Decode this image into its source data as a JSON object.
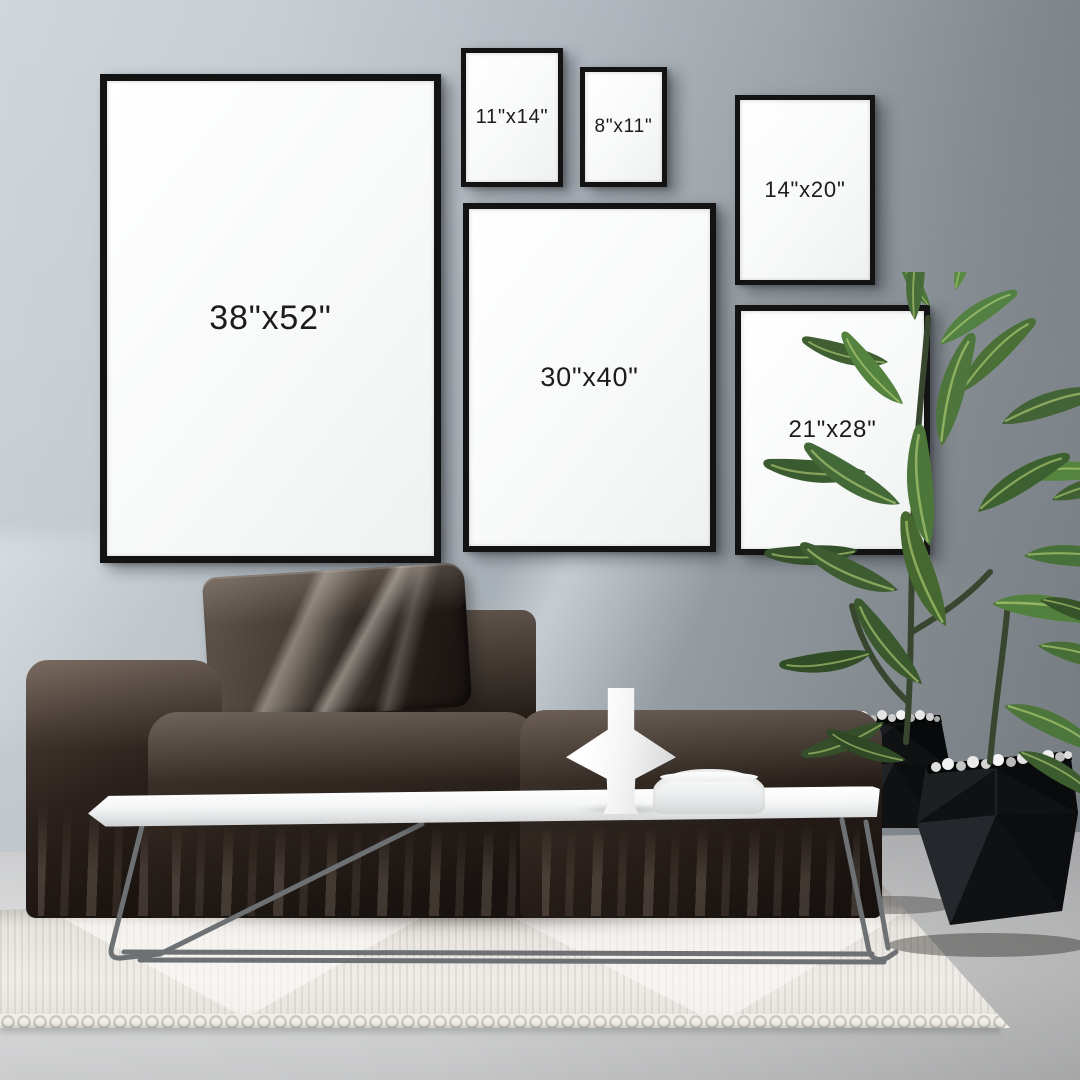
{
  "scene": {
    "description": "Living room gallery-wall mockup comparing six black poster frame sizes above a dark modular sofa, white coffee table with white vase and bowl, rubber plant in two black geometric planters, woven cream rug on concrete floor",
    "colors": {
      "wall_left": "#ccd4d9",
      "wall_right": "#777e83",
      "frame_border": "#131313",
      "frame_face": "#f8f9f9",
      "label_text": "#1c1c1c",
      "sofa": "#251e19",
      "pillow_highlight": "#8d857c",
      "table_top": "#f2f3f4",
      "table_legs": "#6e7174",
      "rug": "#e7e4df",
      "floor": "#cdced0",
      "leaf_green": "#4a7038",
      "planter_black": "#101113",
      "pebbles": "#dcdcdc",
      "vase": "#f2f3f3"
    }
  },
  "frames": [
    {
      "id": "38x52",
      "label": "38\"x52\""
    },
    {
      "id": "11x14",
      "label": "11\"x14\""
    },
    {
      "id": "8x11",
      "label": "8\"x11\""
    },
    {
      "id": "14x20",
      "label": "14\"x20\""
    },
    {
      "id": "30x40",
      "label": "30\"x40\""
    },
    {
      "id": "21x28",
      "label": "21\"x28\""
    }
  ]
}
